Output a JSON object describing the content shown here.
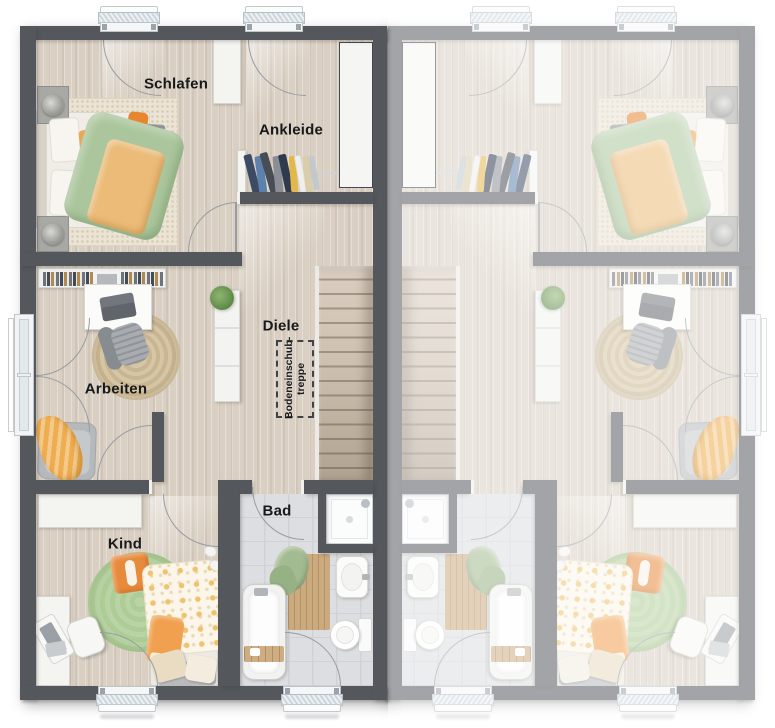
{
  "floorplan": {
    "rooms": {
      "schlafen": {
        "label": "Schlafen"
      },
      "ankleide": {
        "label": "Ankleide"
      },
      "diele": {
        "label": "Diele"
      },
      "arbeiten": {
        "label": "Arbeiten"
      },
      "kind": {
        "label": "Kind"
      },
      "bad": {
        "label": "Bad"
      }
    },
    "annotations": {
      "attic_stairs": {
        "line1": "Bodeneinschub-",
        "line2": "treppe"
      }
    },
    "units": {
      "left": {
        "state": "active"
      },
      "right": {
        "state": "faded-mirror"
      }
    },
    "colors": {
      "wall_active": "#54585d",
      "wall_neighbor": "#9b9ea2",
      "floor_wood": "#d9cfc2",
      "floor_tile": "#dcdee1",
      "duvet_green": "#abc69c",
      "accent_orange": "#eaa756",
      "rug_green": "#b5d1a0",
      "stair_wood": "#c9bcab",
      "label_text": "#17191b"
    }
  }
}
